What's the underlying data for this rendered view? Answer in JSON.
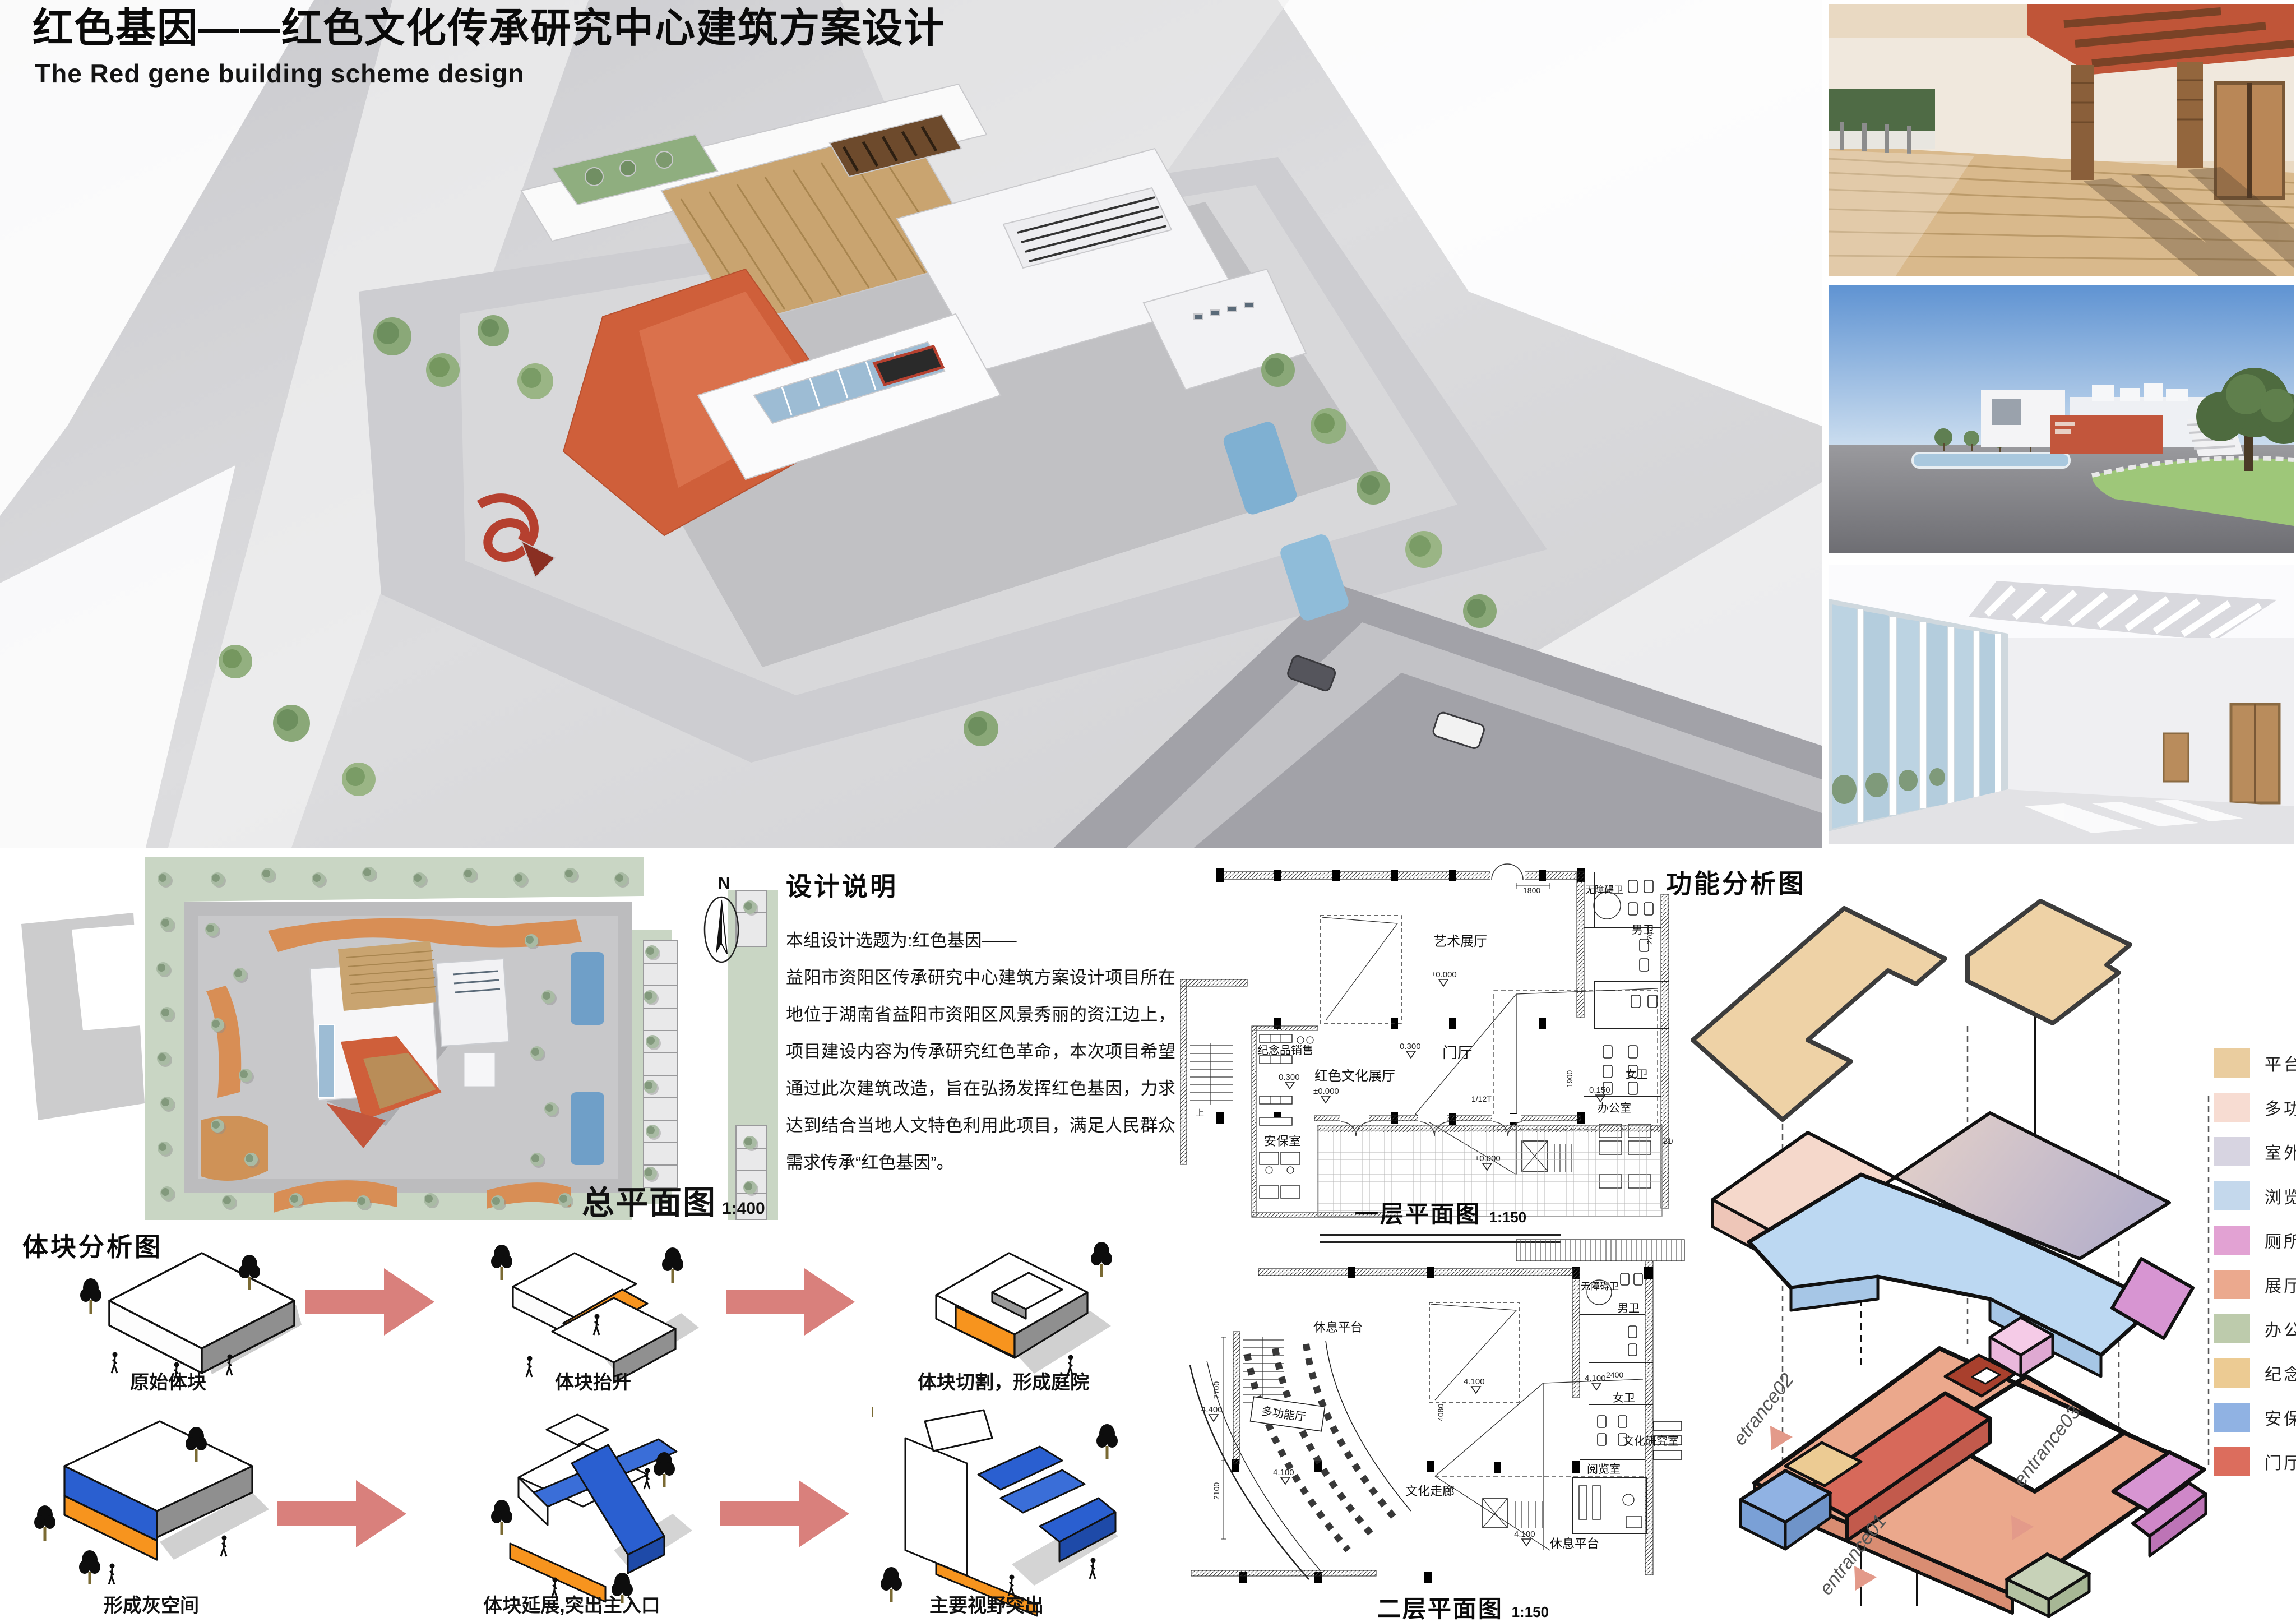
{
  "header": {
    "title_zh": "红色基因——红色文化传承研究中心建筑方案设计",
    "title_en": "The Red gene building scheme design"
  },
  "design_notes": {
    "title": "设计说明",
    "intro": "本组设计选题为:红色基因——",
    "body": "益阳市资阳区传承研究中心建筑方案设计项目所在地位于湖南省益阳市资阳区风景秀丽的资江边上，项目建设内容为传承研究红色革命，本次项目希望通过此次建筑改造，旨在弘扬发挥红色基因，力求达到结合当地人文特色利用此项目，满足人民群众需求传承“红色基因”。"
  },
  "site_plan": {
    "label": "总平面图",
    "scale": "1:400",
    "north": "N"
  },
  "floor_plan_1": {
    "title": "一层平面图",
    "scale": "1:150",
    "rooms": {
      "art": "艺术展厅",
      "red": "红色文化展厅",
      "acc_wc": "无障碍卫",
      "m_wc": "男卫",
      "f_wc": "女卫",
      "office": "办公室",
      "gift": "纪念品销售",
      "lobby": "门厅",
      "security": "安保室"
    },
    "marks": {
      "l0": "±0.000",
      "l03": "0.300",
      "l015": "0.150",
      "d1800": "1800",
      "d2700": "2700",
      "d1900": "1900",
      "d2100": "2100",
      "ramp": "1/12T"
    }
  },
  "floor_plan_2": {
    "title": "二层平面图",
    "scale": "1:150",
    "rooms": {
      "rest": "休息平台",
      "acc_wc": "无障碍卫",
      "m_wc": "男卫",
      "f_wc": "女卫",
      "research": "文化研究室",
      "reading": "阅览室",
      "corridor": "文化走廊",
      "multi": "多功能厅"
    },
    "marks": {
      "l41": "4.100",
      "l44": "4.400",
      "d7700": "7700",
      "d2100": "2100",
      "d2400": "2400",
      "d4080": "4080"
    }
  },
  "function_diagram": {
    "title": "功能分析图",
    "entrances": {
      "e01": "entrance01",
      "e02": "etrance02",
      "e03": "entrance03"
    },
    "legend": [
      {
        "label": "平台",
        "color": "#eacd9f"
      },
      {
        "label": "多功能厅",
        "color": "#f7dcd2"
      },
      {
        "label": "室外平台",
        "color": "#d7d4e1"
      },
      {
        "label": "浏览空间",
        "color": "#c4d8ec"
      },
      {
        "label": "厕所",
        "color": "#e2a2d3"
      },
      {
        "label": "展厅",
        "color": "#eba98e"
      },
      {
        "label": "办公",
        "color": "#bdcbac"
      },
      {
        "label": "纪念品销售",
        "color": "#eccb93"
      },
      {
        "label": "安保室",
        "color": "#90b2e3"
      },
      {
        "label": "门厅",
        "color": "#dc6d5d"
      }
    ]
  },
  "block_analysis": {
    "title": "体块分析图",
    "row1": [
      "原始体块",
      "体块抬升",
      "体块切割，形成庭院"
    ],
    "row2": [
      "形成灰空间",
      "体块延展,突出主入口",
      "主要视野突出"
    ]
  }
}
